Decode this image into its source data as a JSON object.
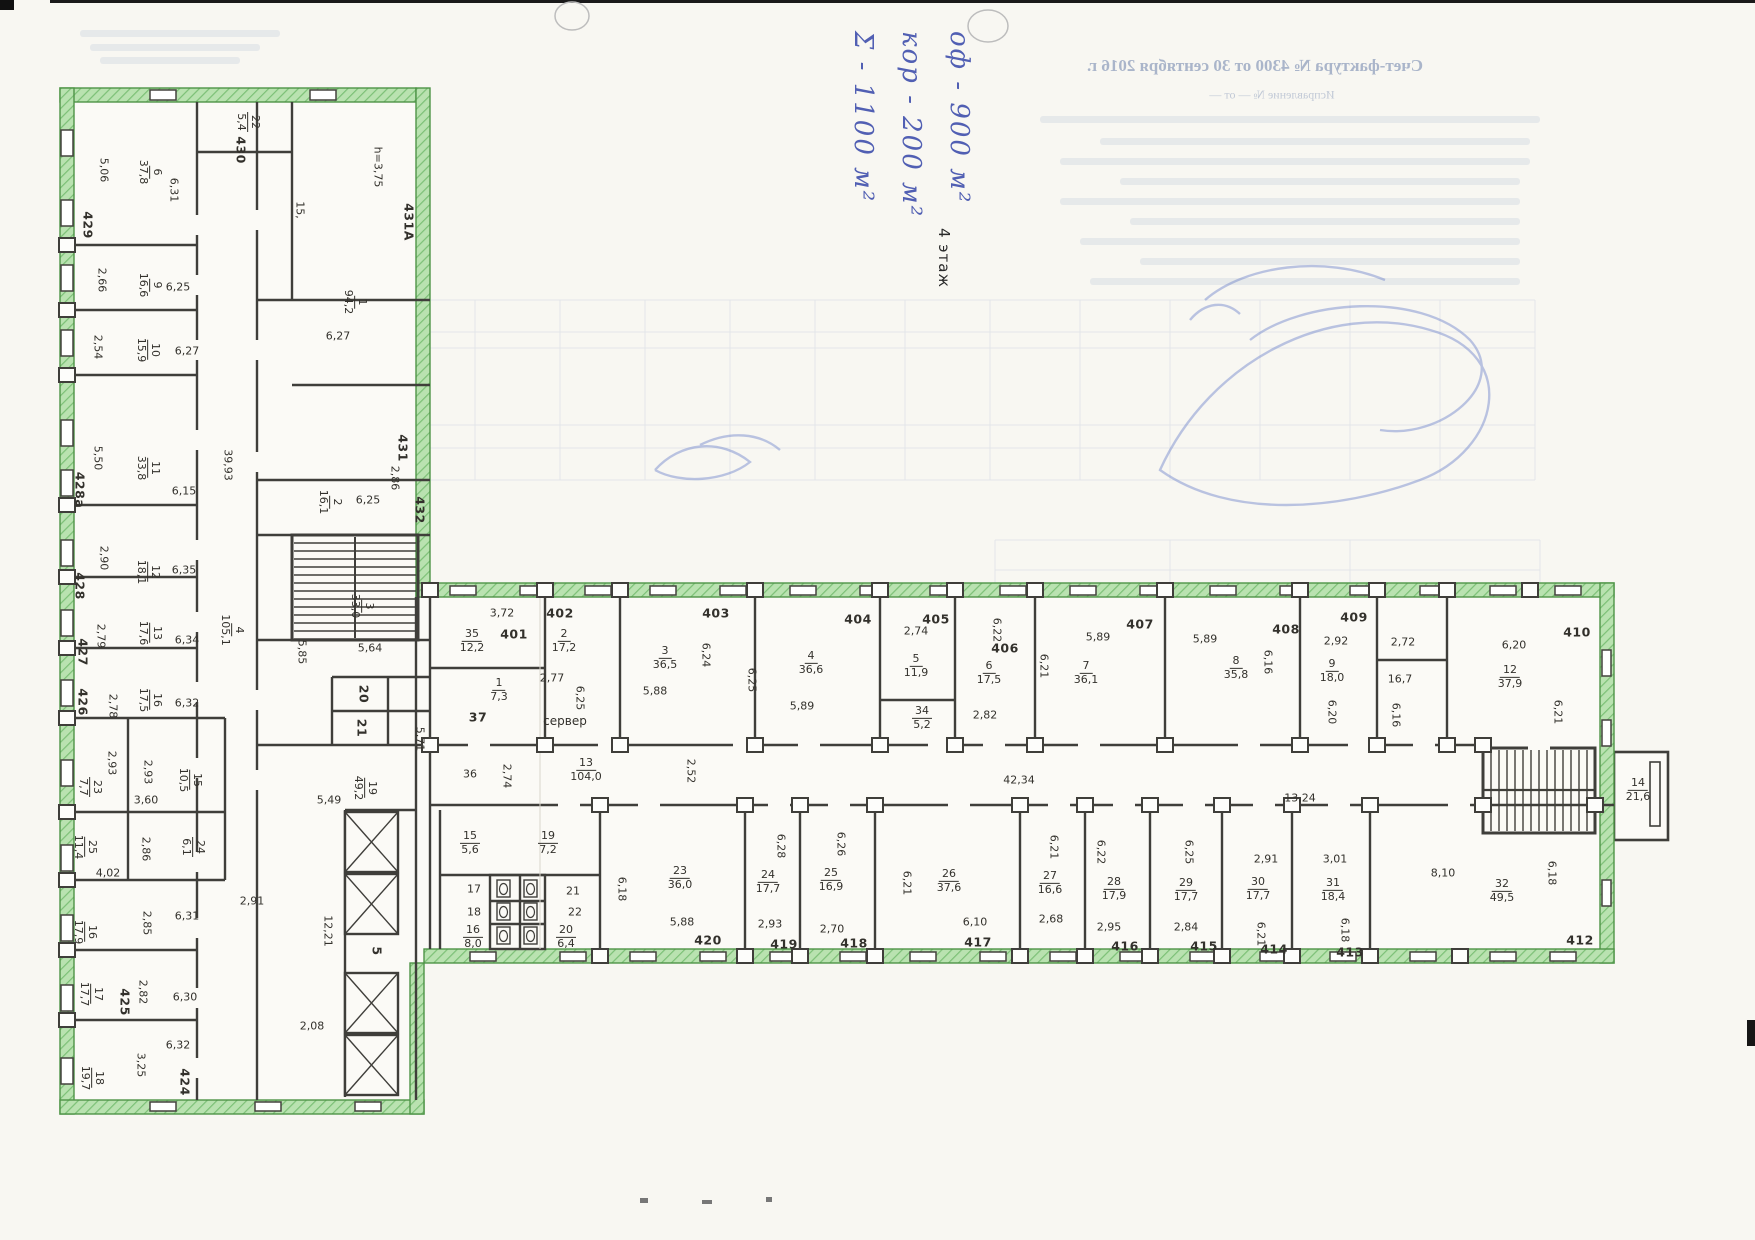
{
  "meta": {
    "floor_label": "4 этаж"
  },
  "handwriting": {
    "ink_color": "#4353ae",
    "lines": [
      "оф - 900 м²",
      "кор - 200 м²",
      "Σ - 1100 м²"
    ]
  },
  "bleedthrough": {
    "title": "Счет-фактура № 4300 от 30 сентября 2016 г.",
    "subtitle": "Исправление № — от —"
  },
  "plan": {
    "wall_highlight_color": "#9ed698",
    "ink_color": "#3f3e3a",
    "pen_color": "#6f84cc",
    "labels": [
      {
        "t": "5,06",
        "x": 104,
        "y": 170,
        "r": 90
      },
      {
        "t": "6,31",
        "x": 174,
        "y": 190,
        "r": 90
      },
      {
        "t": "429",
        "x": 88,
        "y": 225,
        "r": 90,
        "k": "n"
      },
      {
        "t": "430",
        "x": 241,
        "y": 150,
        "r": 90,
        "k": "n"
      },
      {
        "t": "h=3,75",
        "x": 378,
        "y": 167,
        "r": 90
      },
      {
        "t": "15,",
        "x": 300,
        "y": 210,
        "r": 90
      },
      {
        "t": "431А",
        "x": 409,
        "y": 222,
        "r": 90,
        "k": "n"
      },
      {
        "t": "2,66",
        "x": 102,
        "y": 280,
        "r": 90
      },
      {
        "t": "6,25",
        "x": 178,
        "y": 287,
        "r": 0
      },
      {
        "t": "2,54",
        "x": 98,
        "y": 347,
        "r": 90
      },
      {
        "t": "6,27",
        "x": 187,
        "y": 351,
        "r": 0
      },
      {
        "t": "6,27",
        "x": 338,
        "y": 336,
        "r": 0
      },
      {
        "t": "431",
        "x": 403,
        "y": 448,
        "r": 90,
        "k": "n"
      },
      {
        "t": "5,50",
        "x": 98,
        "y": 458,
        "r": 90
      },
      {
        "t": "428а",
        "x": 80,
        "y": 490,
        "r": 90,
        "k": "n"
      },
      {
        "t": "6,15",
        "x": 184,
        "y": 491,
        "r": 0
      },
      {
        "t": "2,86",
        "x": 395,
        "y": 478,
        "r": 90
      },
      {
        "t": "6,25",
        "x": 368,
        "y": 500,
        "r": 0
      },
      {
        "t": "432",
        "x": 420,
        "y": 510,
        "r": 90,
        "k": "n"
      },
      {
        "t": "39,93",
        "x": 228,
        "y": 465,
        "r": 90
      },
      {
        "t": "2,90",
        "x": 104,
        "y": 558,
        "r": 90
      },
      {
        "t": "428",
        "x": 80,
        "y": 586,
        "r": 90,
        "k": "n"
      },
      {
        "t": "6,35",
        "x": 184,
        "y": 570,
        "r": 0
      },
      {
        "t": "2,79",
        "x": 101,
        "y": 636,
        "r": 90
      },
      {
        "t": "427",
        "x": 83,
        "y": 652,
        "r": 90,
        "k": "n"
      },
      {
        "t": "6,34",
        "x": 187,
        "y": 640,
        "r": 0
      },
      {
        "t": "5,64",
        "x": 370,
        "y": 648,
        "r": 0
      },
      {
        "t": "5,85",
        "x": 302,
        "y": 652,
        "r": 90
      },
      {
        "t": "2,78",
        "x": 113,
        "y": 706,
        "r": 90
      },
      {
        "t": "426",
        "x": 83,
        "y": 702,
        "r": 90,
        "k": "n"
      },
      {
        "t": "6,32",
        "x": 187,
        "y": 703,
        "r": 0
      },
      {
        "t": "20",
        "x": 364,
        "y": 694,
        "r": 90,
        "k": "n"
      },
      {
        "t": "21",
        "x": 362,
        "y": 728,
        "r": 90,
        "k": "n"
      },
      {
        "t": "5,71",
        "x": 420,
        "y": 739,
        "r": 90
      },
      {
        "t": "2,93",
        "x": 112,
        "y": 763,
        "r": 90
      },
      {
        "t": "2,93",
        "x": 148,
        "y": 772,
        "r": 90
      },
      {
        "t": "3,60",
        "x": 146,
        "y": 800,
        "r": 0
      },
      {
        "t": "5,49",
        "x": 329,
        "y": 800,
        "r": 0
      },
      {
        "t": "2,86",
        "x": 146,
        "y": 849,
        "r": 90
      },
      {
        "t": "4,02",
        "x": 108,
        "y": 873,
        "r": 0
      },
      {
        "t": "2,85",
        "x": 147,
        "y": 923,
        "r": 90
      },
      {
        "t": "6,31",
        "x": 187,
        "y": 916,
        "r": 0
      },
      {
        "t": "2,91",
        "x": 252,
        "y": 901,
        "r": 0
      },
      {
        "t": "12,21",
        "x": 328,
        "y": 931,
        "r": 90
      },
      {
        "t": "5",
        "x": 377,
        "y": 951,
        "r": 90,
        "k": "n"
      },
      {
        "t": "2,82",
        "x": 143,
        "y": 992,
        "r": 90
      },
      {
        "t": "425",
        "x": 125,
        "y": 1002,
        "r": 90,
        "k": "n"
      },
      {
        "t": "6,30",
        "x": 185,
        "y": 997,
        "r": 0
      },
      {
        "t": "2,08",
        "x": 312,
        "y": 1026,
        "r": 0
      },
      {
        "t": "3,25",
        "x": 141,
        "y": 1065,
        "r": 90
      },
      {
        "t": "6,32",
        "x": 178,
        "y": 1045,
        "r": 0
      },
      {
        "t": "424",
        "x": 185,
        "y": 1082,
        "r": 90,
        "k": "n"
      },
      {
        "t": "3,72",
        "x": 502,
        "y": 613
      },
      {
        "t": "401",
        "x": 514,
        "y": 634,
        "k": "n"
      },
      {
        "t": "402",
        "x": 560,
        "y": 613,
        "k": "n"
      },
      {
        "t": "2,77",
        "x": 552,
        "y": 678
      },
      {
        "t": "37",
        "x": 478,
        "y": 717,
        "k": "n"
      },
      {
        "t": "сервер",
        "x": 565,
        "y": 721,
        "k": "t"
      },
      {
        "t": "6,25",
        "x": 580,
        "y": 698,
        "r": 90
      },
      {
        "t": "403",
        "x": 716,
        "y": 613,
        "k": "n"
      },
      {
        "t": "6,24",
        "x": 706,
        "y": 655,
        "r": 90
      },
      {
        "t": "5,88",
        "x": 655,
        "y": 691
      },
      {
        "t": "6,25",
        "x": 752,
        "y": 680,
        "r": 90
      },
      {
        "t": "404",
        "x": 858,
        "y": 619,
        "k": "n"
      },
      {
        "t": "5,89",
        "x": 802,
        "y": 706
      },
      {
        "t": "405",
        "x": 936,
        "y": 619,
        "k": "n"
      },
      {
        "t": "2,74",
        "x": 916,
        "y": 631
      },
      {
        "t": "6,22",
        "x": 997,
        "y": 630,
        "r": 90
      },
      {
        "t": "406",
        "x": 1005,
        "y": 648,
        "k": "n"
      },
      {
        "t": "6,21",
        "x": 1044,
        "y": 666,
        "r": 90
      },
      {
        "t": "2,82",
        "x": 985,
        "y": 715
      },
      {
        "t": "407",
        "x": 1140,
        "y": 624,
        "k": "n"
      },
      {
        "t": "5,89",
        "x": 1098,
        "y": 637
      },
      {
        "t": "408",
        "x": 1286,
        "y": 629,
        "k": "n"
      },
      {
        "t": "5,89",
        "x": 1205,
        "y": 639
      },
      {
        "t": "6,16",
        "x": 1268,
        "y": 662,
        "r": 90
      },
      {
        "t": "409",
        "x": 1354,
        "y": 617,
        "k": "n"
      },
      {
        "t": "2,92",
        "x": 1336,
        "y": 641
      },
      {
        "t": "6,20",
        "x": 1332,
        "y": 712,
        "r": 90
      },
      {
        "t": "2,72",
        "x": 1403,
        "y": 642
      },
      {
        "t": "16,7",
        "x": 1400,
        "y": 679
      },
      {
        "t": "6,16",
        "x": 1396,
        "y": 715,
        "r": 90
      },
      {
        "t": "410",
        "x": 1577,
        "y": 632,
        "k": "n"
      },
      {
        "t": "6,20",
        "x": 1514,
        "y": 645
      },
      {
        "t": "6,21",
        "x": 1558,
        "y": 712,
        "r": 90
      },
      {
        "t": "2,52",
        "x": 691,
        "y": 771,
        "r": 90
      },
      {
        "t": "42,34",
        "x": 1019,
        "y": 780
      },
      {
        "t": "13,24",
        "x": 1300,
        "y": 798
      },
      {
        "t": "36",
        "x": 470,
        "y": 774
      },
      {
        "t": "2,74",
        "x": 507,
        "y": 776,
        "r": 90
      },
      {
        "t": "17",
        "x": 474,
        "y": 889
      },
      {
        "t": "18",
        "x": 474,
        "y": 912
      },
      {
        "t": "21",
        "x": 573,
        "y": 891
      },
      {
        "t": "22",
        "x": 575,
        "y": 912
      },
      {
        "t": "6,18",
        "x": 622,
        "y": 889,
        "r": 90
      },
      {
        "t": "420",
        "x": 708,
        "y": 940,
        "k": "n"
      },
      {
        "t": "5,88",
        "x": 682,
        "y": 922
      },
      {
        "t": "419",
        "x": 784,
        "y": 944,
        "k": "n"
      },
      {
        "t": "2,93",
        "x": 770,
        "y": 924
      },
      {
        "t": "6,28",
        "x": 781,
        "y": 846,
        "r": 90
      },
      {
        "t": "418",
        "x": 854,
        "y": 943,
        "k": "n"
      },
      {
        "t": "2,70",
        "x": 832,
        "y": 929
      },
      {
        "t": "6,26",
        "x": 841,
        "y": 844,
        "r": 90
      },
      {
        "t": "417",
        "x": 978,
        "y": 942,
        "k": "n"
      },
      {
        "t": "6,10",
        "x": 975,
        "y": 922
      },
      {
        "t": "6,21",
        "x": 907,
        "y": 883,
        "r": 90
      },
      {
        "t": "2,68",
        "x": 1051,
        "y": 919
      },
      {
        "t": "6,21",
        "x": 1054,
        "y": 847,
        "r": 90
      },
      {
        "t": "416",
        "x": 1125,
        "y": 946,
        "k": "n"
      },
      {
        "t": "2,95",
        "x": 1109,
        "y": 927
      },
      {
        "t": "6,22",
        "x": 1101,
        "y": 852,
        "r": 90
      },
      {
        "t": "415",
        "x": 1204,
        "y": 946,
        "k": "n"
      },
      {
        "t": "2,84",
        "x": 1186,
        "y": 927
      },
      {
        "t": "6,25",
        "x": 1189,
        "y": 852,
        "r": 90
      },
      {
        "t": "414",
        "x": 1274,
        "y": 949,
        "k": "n"
      },
      {
        "t": "2,91",
        "x": 1266,
        "y": 859
      },
      {
        "t": "6,21",
        "x": 1261,
        "y": 934,
        "r": 90
      },
      {
        "t": "413",
        "x": 1350,
        "y": 952,
        "k": "n"
      },
      {
        "t": "3,01",
        "x": 1335,
        "y": 859
      },
      {
        "t": "6,18",
        "x": 1345,
        "y": 930,
        "r": 90
      },
      {
        "t": "412",
        "x": 1580,
        "y": 940,
        "k": "n"
      },
      {
        "t": "8,10",
        "x": 1443,
        "y": 873
      },
      {
        "t": "6,18",
        "x": 1552,
        "y": 873,
        "r": 90
      }
    ],
    "fractions": [
      {
        "num": "22",
        "den": "5,4",
        "x": 248,
        "y": 122,
        "r": 90
      },
      {
        "num": "6",
        "den": "37,8",
        "x": 150,
        "y": 172,
        "r": 90
      },
      {
        "num": "9",
        "den": "16,6",
        "x": 150,
        "y": 285,
        "r": 90
      },
      {
        "num": "10",
        "den": "15,9",
        "x": 148,
        "y": 350,
        "r": 90
      },
      {
        "num": "1",
        "den": "94,2",
        "x": 355,
        "y": 302,
        "r": 90
      },
      {
        "num": "11",
        "den": "33,8",
        "x": 148,
        "y": 468,
        "r": 90
      },
      {
        "num": "2",
        "den": "16,1",
        "x": 330,
        "y": 502,
        "r": 90
      },
      {
        "num": "12",
        "den": "18,1",
        "x": 148,
        "y": 572,
        "r": 90
      },
      {
        "num": "3",
        "den": "33,0",
        "x": 362,
        "y": 606,
        "r": 90
      },
      {
        "num": "13",
        "den": "17,6",
        "x": 150,
        "y": 633,
        "r": 90
      },
      {
        "num": "16",
        "den": "17,5",
        "x": 150,
        "y": 700,
        "r": 90
      },
      {
        "num": "23",
        "den": "7,7",
        "x": 90,
        "y": 787,
        "r": 90
      },
      {
        "num": "15",
        "den": "10,5",
        "x": 190,
        "y": 780,
        "r": 90
      },
      {
        "num": "19",
        "den": "49,2",
        "x": 365,
        "y": 788,
        "r": 90
      },
      {
        "num": "4",
        "den": "105,1",
        "x": 232,
        "y": 630,
        "r": 90
      },
      {
        "num": "24",
        "den": "6,1",
        "x": 193,
        "y": 847,
        "r": 90
      },
      {
        "num": "25",
        "den": "11,4",
        "x": 85,
        "y": 847,
        "r": 90
      },
      {
        "num": "16",
        "den": "17,9",
        "x": 85,
        "y": 932,
        "r": 90
      },
      {
        "num": "17",
        "den": "17,7",
        "x": 91,
        "y": 994,
        "r": 90
      },
      {
        "num": "18",
        "den": "19,7",
        "x": 92,
        "y": 1078,
        "r": 90
      },
      {
        "num": "35",
        "den": "12,2",
        "x": 472,
        "y": 641,
        "r": 0
      },
      {
        "num": "1",
        "den": "7,3",
        "x": 499,
        "y": 690,
        "r": 0
      },
      {
        "num": "2",
        "den": "17,2",
        "x": 564,
        "y": 641,
        "r": 0
      },
      {
        "num": "3",
        "den": "36,5",
        "x": 665,
        "y": 658,
        "r": 0
      },
      {
        "num": "4",
        "den": "36,6",
        "x": 811,
        "y": 663,
        "r": 0
      },
      {
        "num": "5",
        "den": "11,9",
        "x": 916,
        "y": 666,
        "r": 0
      },
      {
        "num": "34",
        "den": "5,2",
        "x": 922,
        "y": 718,
        "r": 0
      },
      {
        "num": "6",
        "den": "17,5",
        "x": 989,
        "y": 673,
        "r": 0
      },
      {
        "num": "7",
        "den": "36,1",
        "x": 1086,
        "y": 673,
        "r": 0
      },
      {
        "num": "8",
        "den": "35,8",
        "x": 1236,
        "y": 668,
        "r": 0
      },
      {
        "num": "9",
        "den": "18,0",
        "x": 1332,
        "y": 671,
        "r": 0
      },
      {
        "num": "12",
        "den": "37,9",
        "x": 1510,
        "y": 677,
        "r": 0
      },
      {
        "num": "13",
        "den": "104,0",
        "x": 586,
        "y": 770,
        "r": 0
      },
      {
        "num": "15",
        "den": "5,6",
        "x": 470,
        "y": 843,
        "r": 0
      },
      {
        "num": "19",
        "den": "7,2",
        "x": 548,
        "y": 843,
        "r": 0
      },
      {
        "num": "16",
        "den": "8,0",
        "x": 473,
        "y": 937,
        "r": 0
      },
      {
        "num": "20",
        "den": "6,4",
        "x": 566,
        "y": 937,
        "r": 0
      },
      {
        "num": "23",
        "den": "36,0",
        "x": 680,
        "y": 878,
        "r": 0
      },
      {
        "num": "24",
        "den": "17,7",
        "x": 768,
        "y": 882,
        "r": 0
      },
      {
        "num": "25",
        "den": "16,9",
        "x": 831,
        "y": 880,
        "r": 0
      },
      {
        "num": "26",
        "den": "37,6",
        "x": 949,
        "y": 881,
        "r": 0
      },
      {
        "num": "27",
        "den": "16,6",
        "x": 1050,
        "y": 883,
        "r": 0
      },
      {
        "num": "28",
        "den": "17,9",
        "x": 1114,
        "y": 889,
        "r": 0
      },
      {
        "num": "29",
        "den": "17,7",
        "x": 1186,
        "y": 890,
        "r": 0
      },
      {
        "num": "30",
        "den": "17,7",
        "x": 1258,
        "y": 889,
        "r": 0
      },
      {
        "num": "31",
        "den": "18,4",
        "x": 1333,
        "y": 890,
        "r": 0
      },
      {
        "num": "32",
        "den": "49,5",
        "x": 1502,
        "y": 891,
        "r": 0
      },
      {
        "num": "14",
        "den": "21,6",
        "x": 1638,
        "y": 790,
        "r": 0
      }
    ]
  }
}
